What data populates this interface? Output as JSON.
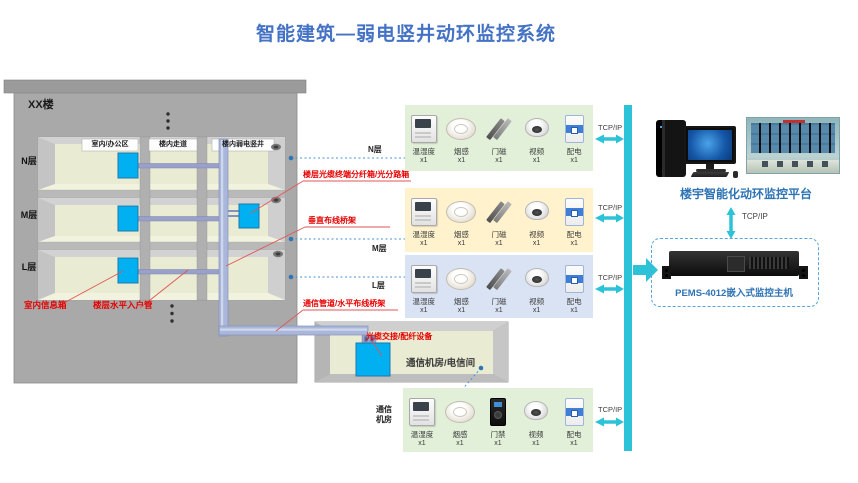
{
  "title": "智能建筑—弱电竖井动环监控系统",
  "building": {
    "name": "XX楼",
    "floors": [
      "N层",
      "M层",
      "L层"
    ],
    "zones": [
      "室内/办公区",
      "楼内走道",
      "楼内弱电竖井"
    ],
    "indoor_box_label": "室内信息箱",
    "entry_pipe_label": "楼层水平入户管"
  },
  "annotations": {
    "fiber_terminal_box": "楼层光缆终端分纤箱/光分路箱",
    "vertical_cable_tray": "垂直布线桥架",
    "comm_duct": "通信管道/水平布线桥架",
    "fiber_cross_equipment": "光缆交接/配纤设备",
    "telecom_room": "通信机房/电信间"
  },
  "network": {
    "protocol": "TCP/IP"
  },
  "rows": [
    {
      "floor": "N层",
      "devices": [
        {
          "name": "温湿度",
          "count": "x1"
        },
        {
          "name": "烟感",
          "count": "x1"
        },
        {
          "name": "门磁",
          "count": "x1"
        },
        {
          "name": "视频",
          "count": "x1"
        },
        {
          "name": "配电",
          "count": "x1"
        }
      ]
    },
    {
      "floor": "M层",
      "devices": [
        {
          "name": "温湿度",
          "count": "x1"
        },
        {
          "name": "烟感",
          "count": "x1"
        },
        {
          "name": "门磁",
          "count": "x1"
        },
        {
          "name": "视频",
          "count": "x1"
        },
        {
          "name": "配电",
          "count": "x1"
        }
      ]
    },
    {
      "floor": "L层",
      "devices": [
        {
          "name": "温湿度",
          "count": "x1"
        },
        {
          "name": "烟感",
          "count": "x1"
        },
        {
          "name": "门磁",
          "count": "x1"
        },
        {
          "name": "视频",
          "count": "x1"
        },
        {
          "name": "配电",
          "count": "x1"
        }
      ]
    },
    {
      "floor": "通信机房",
      "devices": [
        {
          "name": "温湿度",
          "count": "x1"
        },
        {
          "name": "烟感",
          "count": "x1"
        },
        {
          "name": "门禁",
          "count": "x1"
        },
        {
          "name": "视频",
          "count": "x1"
        },
        {
          "name": "配电",
          "count": "x1"
        }
      ]
    }
  ],
  "platform": {
    "label": "楼宇智能化动环监控平台"
  },
  "host": {
    "label": "PEMS-4012嵌入式监控主机"
  },
  "colors": {
    "title_blue": "#4472c4",
    "label_blue": "#2e74b5",
    "annotation_red": "#e60000",
    "bus_cyan": "#2cc3d9",
    "row_green": "#e2f0d9",
    "row_yellow": "#fff2cc",
    "row_blue": "#dae3f3",
    "device_box_cyan": "#00b0f0",
    "dotted_link_blue": "#4a90d9"
  }
}
